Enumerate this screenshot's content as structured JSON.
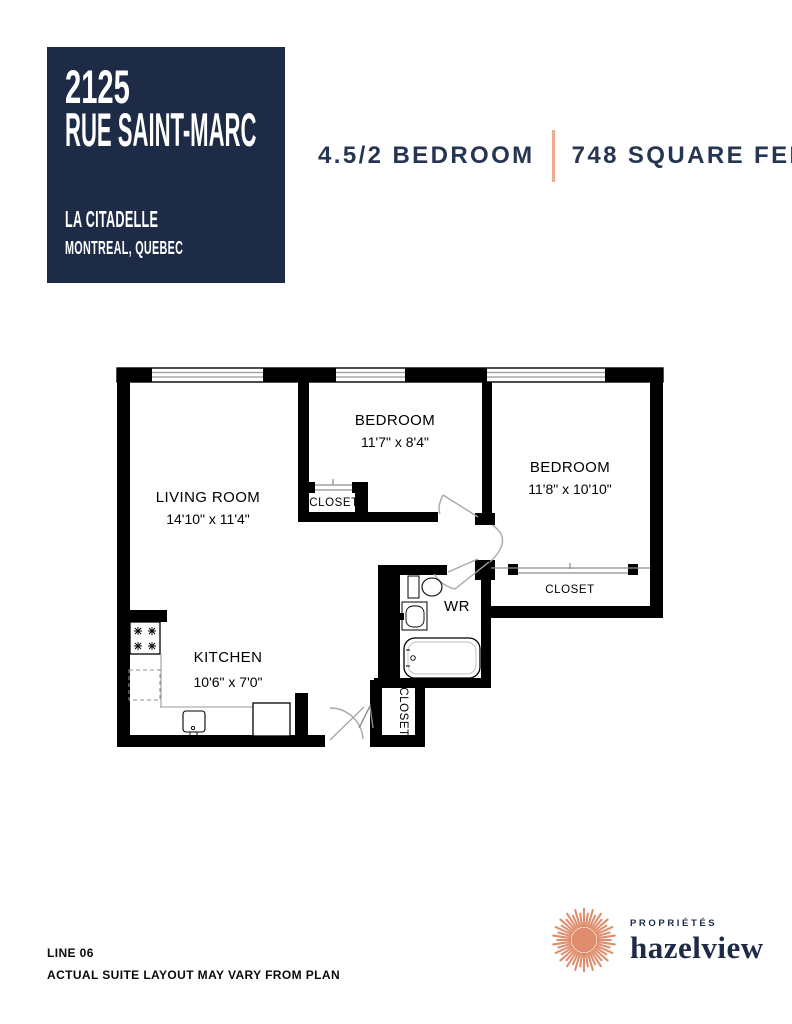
{
  "colors": {
    "navy": "#1d2b47",
    "header_text_navy": "#263551",
    "divider_coral": "#eeab90",
    "logo_coral": "#df8e6d"
  },
  "title_block": {
    "address_line1": "2125",
    "address_line2": "RUE SAINT-MARC",
    "property_name": "LA CITADELLE",
    "city": "MONTREAL, QUEBEC"
  },
  "header": {
    "unit_type": "4.5/2 BEDROOM",
    "area": "748 SQUARE FEET"
  },
  "floor_plan": {
    "living_room": {
      "name": "LIVING ROOM",
      "dims": "14'10\" x 11'4\""
    },
    "bedroom_top": {
      "name": "BEDROOM",
      "dims": "11'7\" x 8'4\""
    },
    "bedroom_right": {
      "name": "BEDROOM",
      "dims": "11'8\" x 10'10\""
    },
    "kitchen": {
      "name": "KITCHEN",
      "dims": "10'6\" x 7'0\""
    },
    "washroom": {
      "label": "WR"
    },
    "closet_bedroom_top": "CLOSET",
    "closet_bedroom_right": "CLOSET",
    "closet_entry": "CLOSET"
  },
  "footer": {
    "line_label": "LINE 06",
    "disclaimer": "ACTUAL SUITE LAYOUT MAY VARY FROM PLAN"
  },
  "logo": {
    "tagline": "PROPRIÉTÉS",
    "brand": "hazelview"
  }
}
